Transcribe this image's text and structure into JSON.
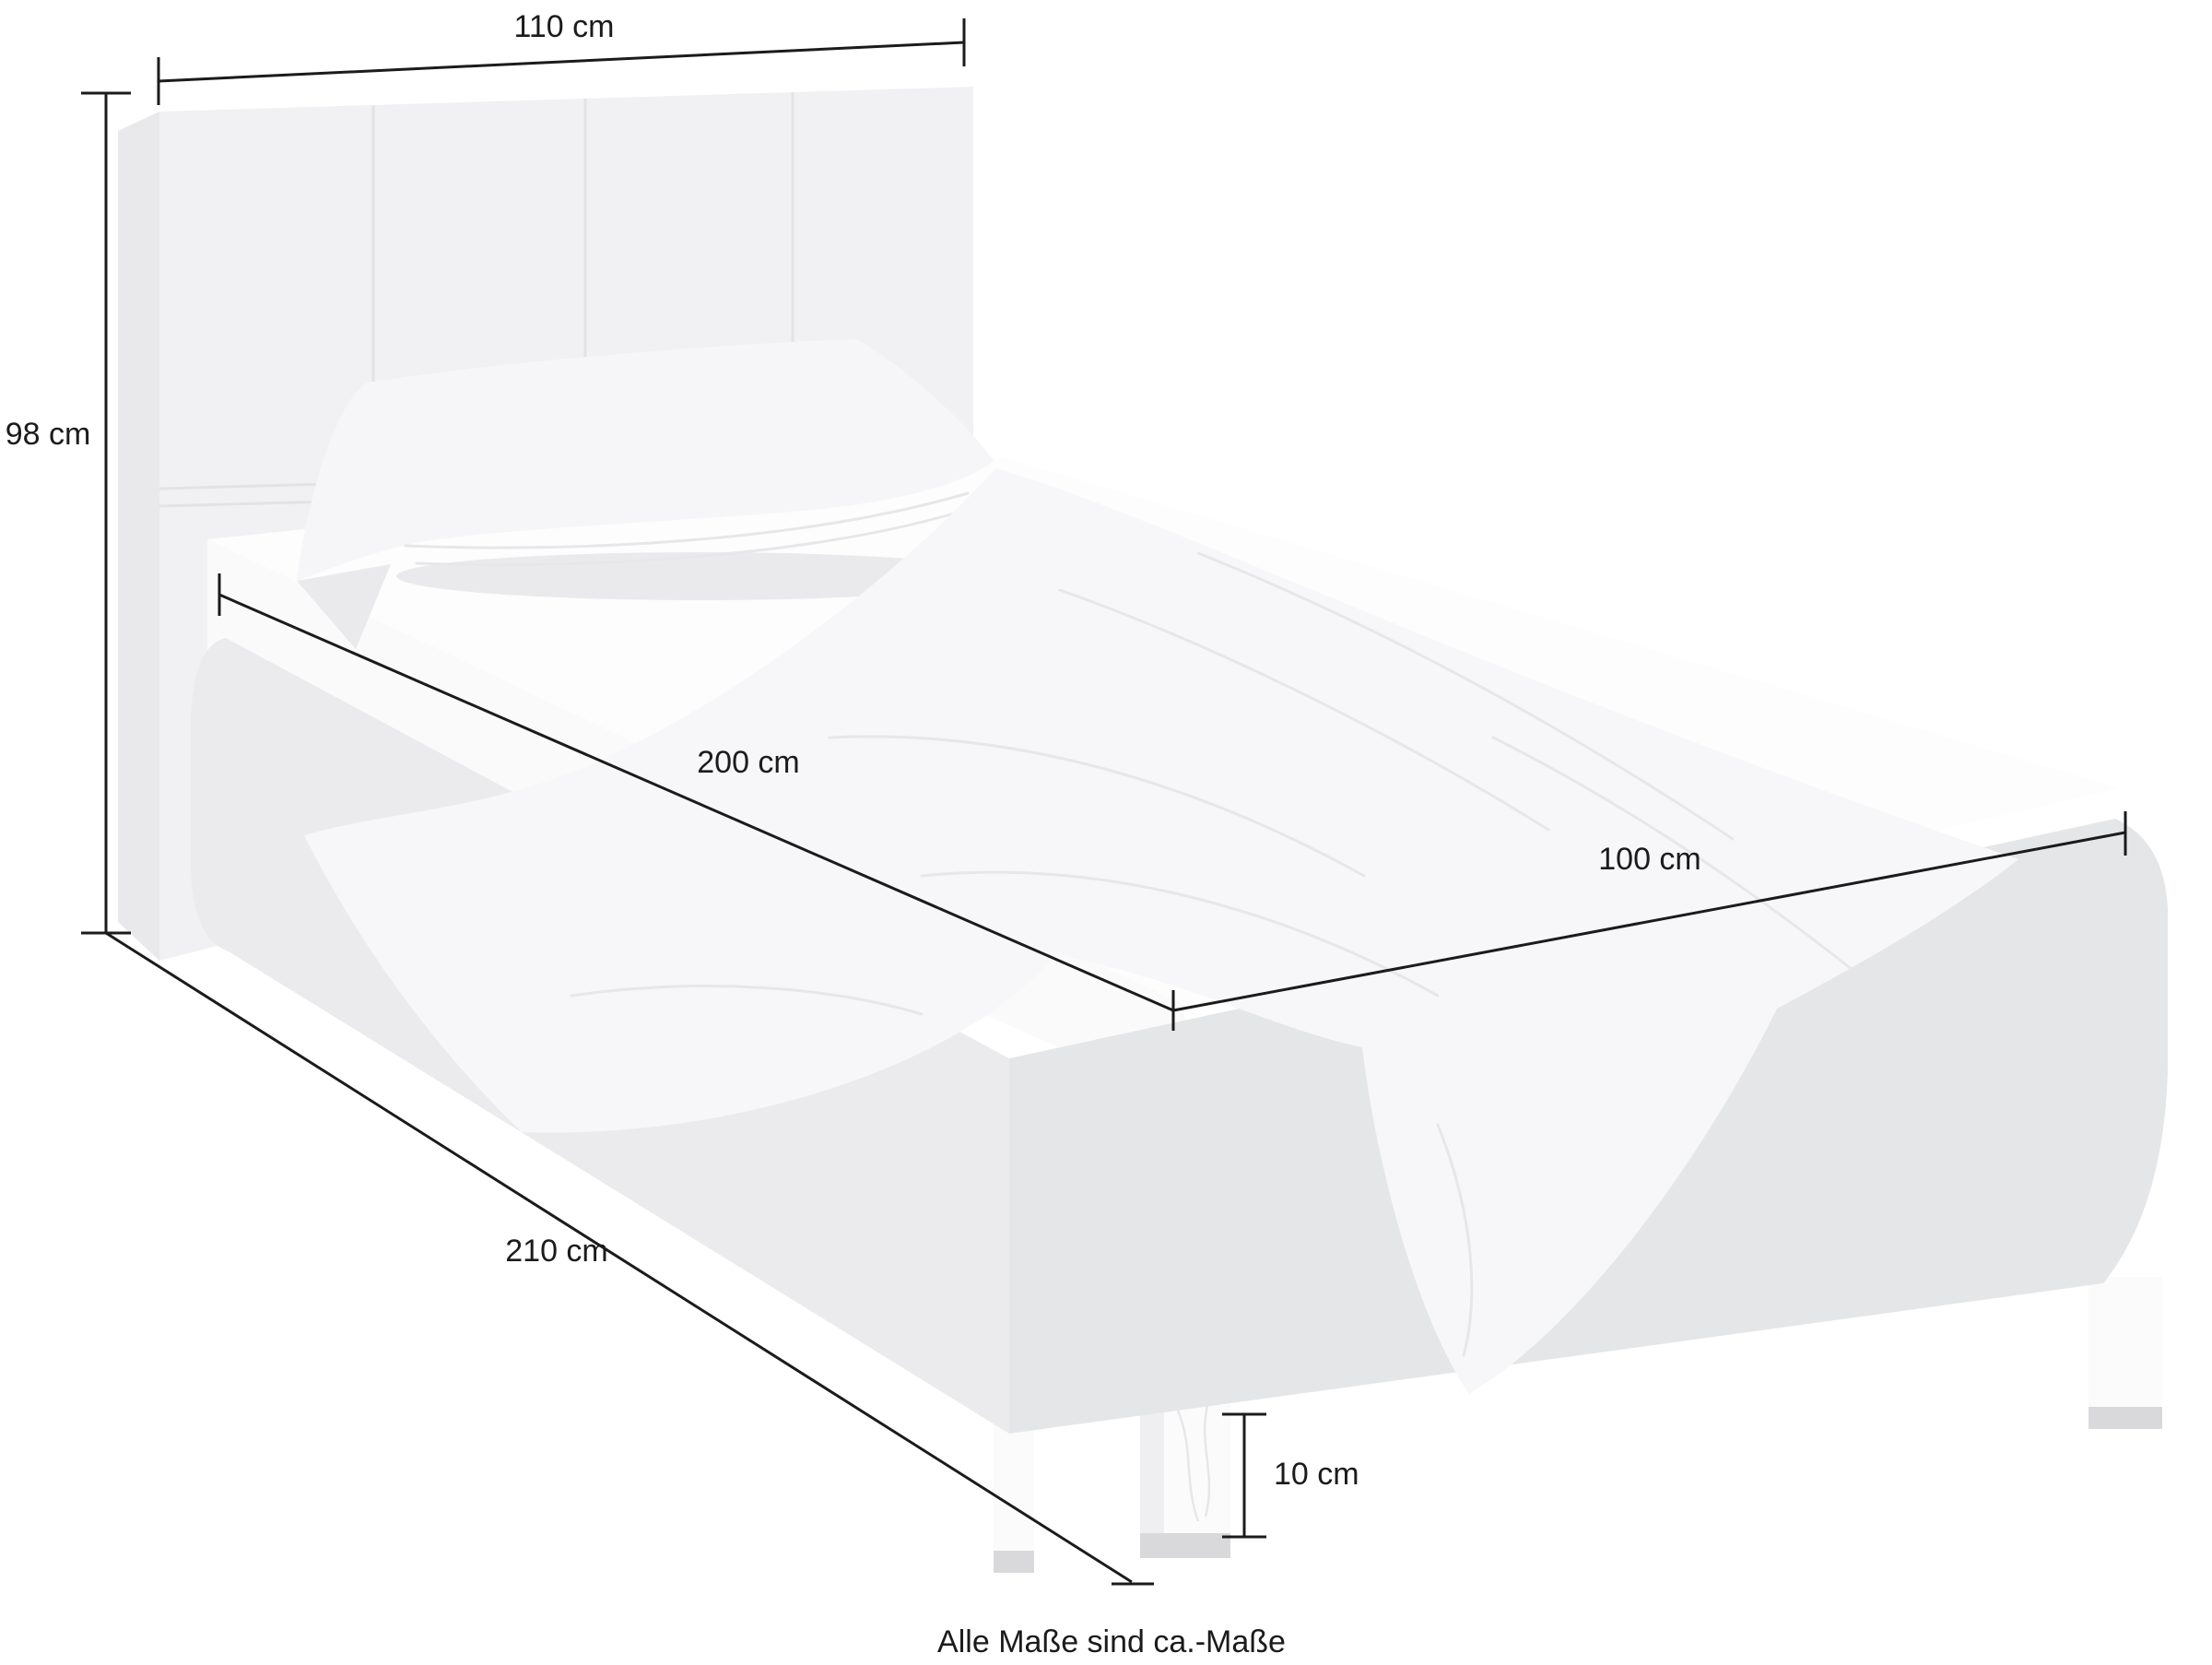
{
  "page": {
    "type": "product-dimension-diagram",
    "subject": "upholstered single bed with headboard, pillow, duvet and chrome feet"
  },
  "dimensions": {
    "headboard_width": "110 cm",
    "headboard_height": "98 cm",
    "mattress_length": "200 cm",
    "mattress_width": "100 cm",
    "total_length": "210 cm",
    "leg_height": "10 cm"
  },
  "caption": "Alle Maße sind ca.-Maße",
  "colors": {
    "background": "#ffffff",
    "ink": "#1b1b1b",
    "headboard": "#f1f1f3",
    "headboard_side": "#e9e9eb",
    "seam": "#e3e3e6",
    "mattress_top": "#fdfdfe",
    "mattress_face": "#fafafb",
    "pillow": "#f6f6f8",
    "duvet": "#f7f7f9",
    "shading": "#eaeaed",
    "crease": "#e7e7ea",
    "frame_rail": "#ebebed",
    "frame_foot": "#e5e6e8",
    "leg": "#fbfbfc",
    "leg_side": "#efeff1",
    "leg_foot": "#d9d9db"
  }
}
